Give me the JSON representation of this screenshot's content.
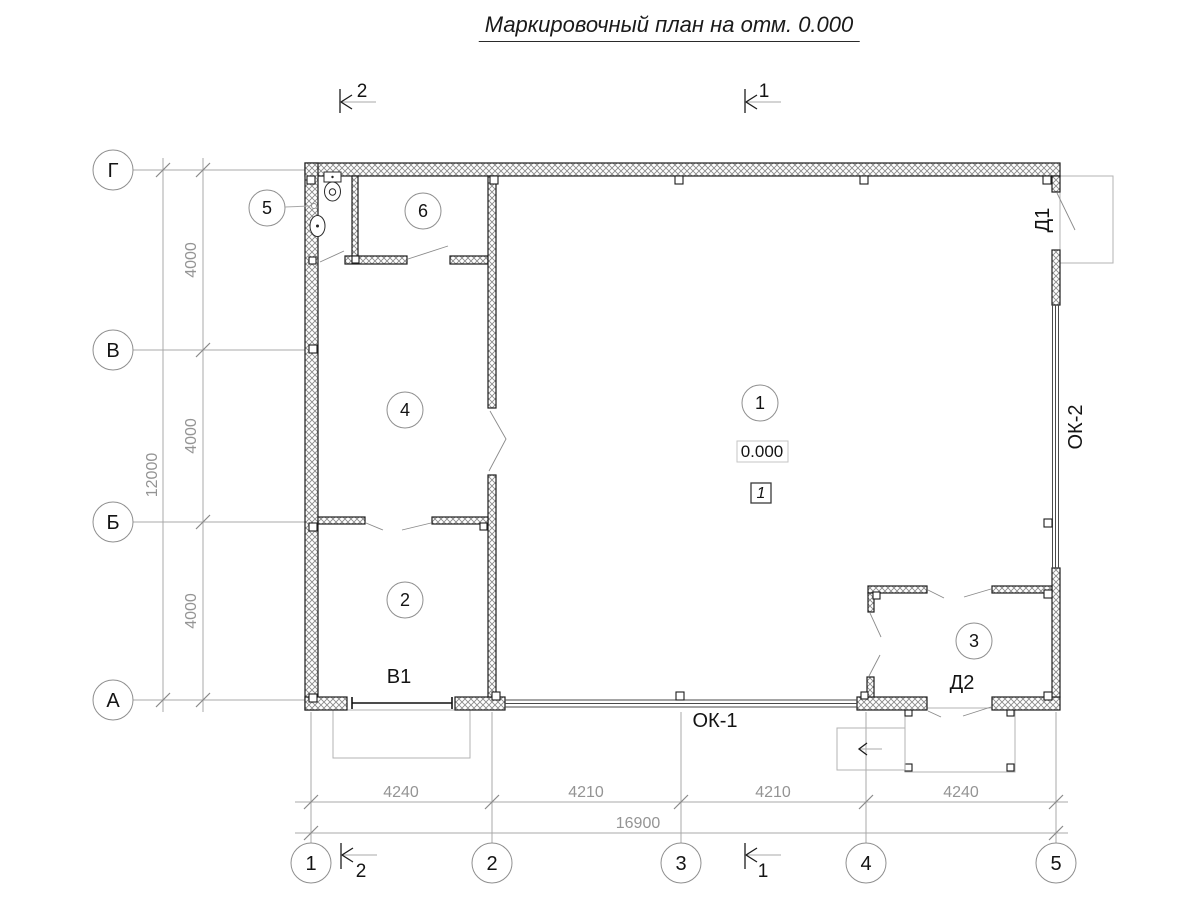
{
  "title": "Маркировочный план на отм. 0.000",
  "section_marks": {
    "top_left": "2",
    "top_right": "1",
    "bottom_left": "2",
    "bottom_right": "1"
  },
  "axes": {
    "rows": [
      "Г",
      "В",
      "Б",
      "А"
    ],
    "cols": [
      "1",
      "2",
      "3",
      "4",
      "5"
    ]
  },
  "dimensions": {
    "left_chain": [
      "4000",
      "4000",
      "4000"
    ],
    "left_total": "12000",
    "bottom_chain": [
      "4240",
      "4210",
      "4210",
      "4240"
    ],
    "bottom_total": "16900"
  },
  "rooms": [
    "1",
    "2",
    "3",
    "4",
    "5",
    "6"
  ],
  "labels": {
    "gate": "В1",
    "window_strip_1": "ОК-1",
    "window_strip_2": "ОК-2",
    "door_1": "Д1",
    "door_2": "Д2",
    "elevation": "0.000",
    "floor_type": "1"
  }
}
